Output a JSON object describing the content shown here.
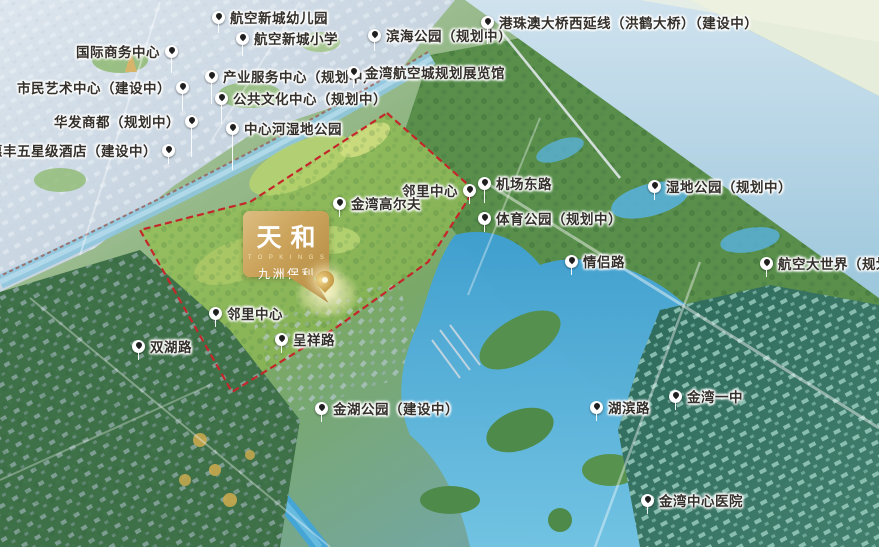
{
  "map_title": "天和 九洲保利 项目区位鸟瞰图",
  "logo": {
    "name": "天和",
    "subtitle": "T O P K I N G S",
    "company": "九洲保利"
  },
  "pin": {
    "x": 325,
    "y": 293
  },
  "boundary": {
    "points": "387,113 474,190 428,262 337,327 232,392 140,230 250,202",
    "color": "#c3272b",
    "style": "dashed"
  },
  "palette": {
    "boundary_red": "#c3272b",
    "logo_gold": "#c9a45b",
    "water_blue": "#45a8d6",
    "park_green": "#8cbb5e",
    "city_teal": "#2e6a5b",
    "label_text": "#332f2b",
    "marker_white": "#ffffff"
  },
  "markers": [
    {
      "label": "航空新城幼儿园",
      "x": 219,
      "y": 17,
      "side": "right",
      "stem": 10
    },
    {
      "label": "国际商务中心",
      "x": 171,
      "y": 51,
      "side": "left",
      "stem": 16
    },
    {
      "label": "航空新城小学",
      "x": 243,
      "y": 38,
      "side": "right",
      "stem": 12
    },
    {
      "label": "滨海公园（规划中）",
      "x": 375,
      "y": 35,
      "side": "right",
      "stem": 10
    },
    {
      "label": "港珠澳大桥西延线（洪鹤大桥）（建设中）",
      "x": 488,
      "y": 22,
      "side": "right",
      "stem": 16
    },
    {
      "label": "产业服务中心（规划中）",
      "x": 212,
      "y": 76,
      "side": "right",
      "stem": 22
    },
    {
      "label": "金湾航空城规划展览馆",
      "x": 354,
      "y": 72,
      "side": "right",
      "stem": 10
    },
    {
      "label": "市民艺术中心（建设中）",
      "x": 182,
      "y": 87,
      "side": "left",
      "stem": 18
    },
    {
      "label": "公共文化中心（规划中）",
      "x": 222,
      "y": 98,
      "side": "right",
      "stem": 20
    },
    {
      "label": "华发商都（规划中）",
      "x": 191,
      "y": 121,
      "side": "left",
      "stem": 30
    },
    {
      "label": "中心河湿地公园",
      "x": 233,
      "y": 128,
      "side": "right",
      "stem": 36
    },
    {
      "label": "毛林惠丰五星级酒店（建设中）",
      "x": 168,
      "y": 150,
      "side": "left",
      "stem": 8
    },
    {
      "label": "邻里中心",
      "x": 469,
      "y": 190,
      "side": "left",
      "stem": 8
    },
    {
      "label": "机场东路",
      "x": 485,
      "y": 183,
      "side": "right",
      "stem": 14
    },
    {
      "label": "湿地公园（规划中）",
      "x": 655,
      "y": 186,
      "side": "right",
      "stem": 8
    },
    {
      "label": "金湾高尔夫",
      "x": 340,
      "y": 203,
      "side": "right",
      "stem": 8
    },
    {
      "label": "体育公园（规划中）",
      "x": 485,
      "y": 218,
      "side": "right",
      "stem": 8
    },
    {
      "label": "情侣路",
      "x": 572,
      "y": 261,
      "side": "right",
      "stem": 8
    },
    {
      "label": "航空大世界（规划中）",
      "x": 767,
      "y": 263,
      "side": "right",
      "stem": 8
    },
    {
      "label": "邻里中心",
      "x": 216,
      "y": 313,
      "side": "right",
      "stem": 8
    },
    {
      "label": "双湖路",
      "x": 139,
      "y": 346,
      "side": "right",
      "stem": 8
    },
    {
      "label": "呈祥路",
      "x": 282,
      "y": 339,
      "side": "right",
      "stem": 8
    },
    {
      "label": "金湖公园（建设中）",
      "x": 322,
      "y": 408,
      "side": "right",
      "stem": 8
    },
    {
      "label": "湖滨路",
      "x": 597,
      "y": 407,
      "side": "right",
      "stem": 8
    },
    {
      "label": "金湾一中",
      "x": 676,
      "y": 396,
      "side": "right",
      "stem": 8
    },
    {
      "label": "金湾中心医院",
      "x": 648,
      "y": 500,
      "side": "right",
      "stem": 8
    }
  ]
}
